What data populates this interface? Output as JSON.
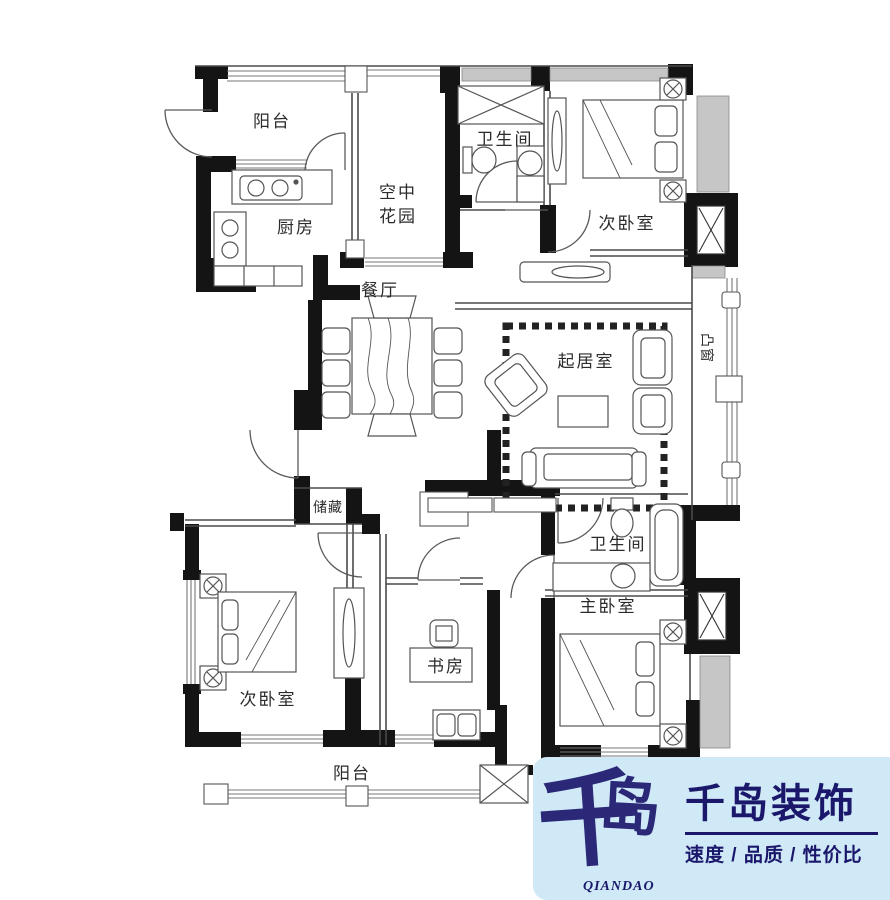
{
  "plan": {
    "labels": {
      "balcony_top": "阳台",
      "kitchen": "厨房",
      "sky_garden_1": "空中",
      "sky_garden_2": "花园",
      "bath_top": "卫生间",
      "bedroom_top_right": "次卧室",
      "dining": "餐厅",
      "living": "起居室",
      "bay_window": "凸窗",
      "storage": "储藏",
      "bedroom_bottom_left": "次卧室",
      "study": "书房",
      "bath_bottom": "卫生间",
      "master_bedroom": "主卧室",
      "balcony_bottom": "阳台"
    }
  },
  "logo": {
    "calligraphy_char1": "千",
    "calligraphy_char2": "岛",
    "romanized": "QIANDAO",
    "company_name": "千岛装饰",
    "tagline": "速度 / 品质 / 性价比",
    "colors": {
      "background": "#cfe9f7",
      "navy": "#1b186b"
    }
  }
}
